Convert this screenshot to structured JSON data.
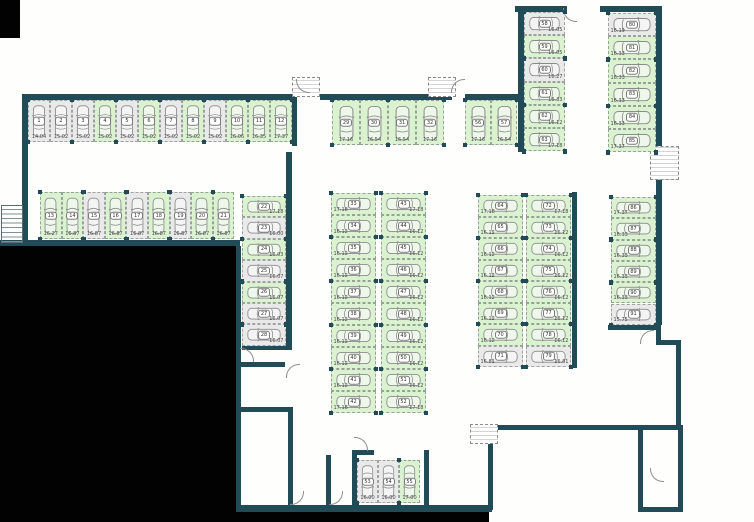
{
  "title": "underground parking garage floor plan",
  "colors": {
    "available_fill": "#daf2d0",
    "occupied_fill": "#e9e9e9",
    "wall": "#224b58",
    "background": "#ffffff",
    "outside_mask": "#000000",
    "dimension_text": "#4a4a4a"
  },
  "icons": {
    "car-icon": "top-view car outline drawn in each stall",
    "door-swing-icon": "quarter-circle arc",
    "vent-shaft-icon": "dashed hatched box",
    "stairs-icon": "striped rectangle",
    "column-pillar-icon": "small dark square"
  },
  "plan": {
    "groups": [
      {
        "id": "row-top-left",
        "x": 28,
        "y": 100,
        "sw": 22,
        "sh": 42,
        "dir": "up",
        "dim_side": "bottom",
        "stalls": [
          {
            "n": "1",
            "dim": "14.04",
            "free": false
          },
          {
            "n": "2",
            "dim": "15.02",
            "free": false
          },
          {
            "n": "3",
            "dim": "15.02",
            "free": false
          },
          {
            "n": "4",
            "dim": "15.02",
            "free": true
          },
          {
            "n": "5",
            "dim": "15.02",
            "free": false
          },
          {
            "n": "6",
            "dim": "15.02",
            "free": true
          },
          {
            "n": "7",
            "dim": "15.02",
            "free": false
          },
          {
            "n": "8",
            "dim": "15.02",
            "free": true
          },
          {
            "n": "9",
            "dim": "15.02",
            "free": false
          },
          {
            "n": "10",
            "dim": "16.06",
            "free": true
          },
          {
            "n": "11",
            "dim": "16.35",
            "free": true
          },
          {
            "n": "12",
            "dim": "17.37",
            "free": true
          }
        ]
      },
      {
        "id": "row-second-left",
        "x": 40,
        "y": 192,
        "sw": 21.6,
        "sh": 47,
        "dir": "up",
        "dim_side": "bottom",
        "stalls": [
          {
            "n": "13",
            "dim": "16.27",
            "free": true
          },
          {
            "n": "14",
            "dim": "16.87",
            "free": true
          },
          {
            "n": "15",
            "dim": "16.87",
            "free": false
          },
          {
            "n": "16",
            "dim": "16.87",
            "free": true
          },
          {
            "n": "17",
            "dim": "16.87",
            "free": false
          },
          {
            "n": "18",
            "dim": "16.87",
            "free": true
          },
          {
            "n": "19",
            "dim": "16.87",
            "free": false
          },
          {
            "n": "20",
            "dim": "16.87",
            "free": true
          },
          {
            "n": "21",
            "dim": "16.87",
            "free": true
          }
        ]
      },
      {
        "id": "col-left",
        "x": 242,
        "y": 196,
        "sw": 44,
        "sh": 21.4,
        "dir": "left",
        "dim_side": "right",
        "stalls": [
          {
            "n": "22",
            "dim": "17.18",
            "free": true
          },
          {
            "n": "23",
            "dim": "16.00",
            "free": false
          },
          {
            "n": "24",
            "dim": "16.03",
            "free": true
          },
          {
            "n": "25",
            "dim": "16.07",
            "free": false
          },
          {
            "n": "26",
            "dim": "16.07",
            "free": true
          },
          {
            "n": "27",
            "dim": "16.07",
            "free": false
          },
          {
            "n": "28",
            "dim": "16.07",
            "free": false
          }
        ]
      },
      {
        "id": "row-mid-top",
        "x": 332,
        "y": 100,
        "sw": 28,
        "sh": 45,
        "dir": "up",
        "dim_side": "bottom",
        "stalls": [
          {
            "n": "29",
            "dim": "17.16",
            "free": true
          },
          {
            "n": "30",
            "dim": "16.54",
            "free": true
          },
          {
            "n": "31",
            "dim": "16.54",
            "free": true
          },
          {
            "n": "32",
            "dim": "17.16",
            "free": true
          }
        ]
      },
      {
        "id": "block-mid-west",
        "x": 331,
        "y": 193,
        "sw": 45,
        "sh": 22,
        "dir": "right",
        "dim_side": "left",
        "stalls": [
          {
            "n": "33",
            "dim": "17.18",
            "free": true
          },
          {
            "n": "34",
            "dim": "16.12",
            "free": true
          },
          {
            "n": "35",
            "dim": "16.12",
            "free": true
          },
          {
            "n": "36",
            "dim": "16.12",
            "free": true
          },
          {
            "n": "37",
            "dim": "16.12",
            "free": true
          },
          {
            "n": "38",
            "dim": "16.12",
            "free": true
          },
          {
            "n": "39",
            "dim": "16.12",
            "free": true
          },
          {
            "n": "40",
            "dim": "16.12",
            "free": true
          },
          {
            "n": "41",
            "dim": "16.12",
            "free": true
          },
          {
            "n": "42",
            "dim": "17.18",
            "free": true
          }
        ]
      },
      {
        "id": "block-mid-east",
        "x": 381,
        "y": 193,
        "sw": 45,
        "sh": 22,
        "dir": "left",
        "dim_side": "right",
        "stalls": [
          {
            "n": "43",
            "dim": "17.18",
            "free": true
          },
          {
            "n": "44",
            "dim": "16.12",
            "free": true
          },
          {
            "n": "45",
            "dim": "16.12",
            "free": true
          },
          {
            "n": "46",
            "dim": "16.12",
            "free": true
          },
          {
            "n": "47",
            "dim": "16.12",
            "free": true
          },
          {
            "n": "48",
            "dim": "16.12",
            "free": true
          },
          {
            "n": "49",
            "dim": "16.12",
            "free": true
          },
          {
            "n": "50",
            "dim": "16.12",
            "free": true
          },
          {
            "n": "51",
            "dim": "16.12",
            "free": true
          },
          {
            "n": "52",
            "dim": "17.18",
            "free": true
          }
        ]
      },
      {
        "id": "room-bottom-center",
        "x": 357,
        "y": 460,
        "sw": 21,
        "sh": 43,
        "dir": "down",
        "dim_side": "bottom",
        "stalls": [
          {
            "n": "53",
            "dim": "16.00",
            "free": false
          },
          {
            "n": "54",
            "dim": "16.00",
            "free": false
          },
          {
            "n": "55",
            "dim": "17.00",
            "free": true
          }
        ]
      },
      {
        "id": "row-56-57",
        "x": 465,
        "y": 100,
        "sw": 26,
        "sh": 45,
        "dir": "up",
        "dim_side": "bottom",
        "stalls": [
          {
            "n": "56",
            "dim": "17.16",
            "free": true
          },
          {
            "n": "57",
            "dim": "16.54",
            "free": true
          }
        ]
      },
      {
        "id": "col-topright-west",
        "x": 524,
        "y": 12,
        "sw": 41,
        "sh": 23.2,
        "dir": "left",
        "dim_side": "right",
        "stalls": [
          {
            "n": "58",
            "dim": "16.05",
            "free": false
          },
          {
            "n": "59",
            "dim": "16.05",
            "free": true
          },
          {
            "n": "60",
            "dim": "16.27",
            "free": false
          },
          {
            "n": "61",
            "dim": "16.33",
            "free": true
          },
          {
            "n": "62",
            "dim": "16.12",
            "free": true
          },
          {
            "n": "63",
            "dim": "17.18",
            "free": true
          }
        ]
      },
      {
        "id": "col-topright-east",
        "x": 608,
        "y": 13,
        "sw": 48,
        "sh": 23.2,
        "dir": "right",
        "dim_side": "left",
        "stalls": [
          {
            "n": "80",
            "dim": "16.19",
            "free": false
          },
          {
            "n": "81",
            "dim": "16.33",
            "free": true
          },
          {
            "n": "82",
            "dim": "16.33",
            "free": true
          },
          {
            "n": "83",
            "dim": "16.33",
            "free": true
          },
          {
            "n": "84",
            "dim": "16.33",
            "free": true
          },
          {
            "n": "85",
            "dim": "17.37",
            "free": true
          }
        ]
      },
      {
        "id": "block-right-west",
        "x": 478,
        "y": 195,
        "sw": 45,
        "sh": 21.5,
        "dir": "right",
        "dim_side": "left",
        "stalls": [
          {
            "n": "64",
            "dim": "17.18",
            "free": true
          },
          {
            "n": "65",
            "dim": "16.12",
            "free": true
          },
          {
            "n": "66",
            "dim": "16.12",
            "free": true
          },
          {
            "n": "67",
            "dim": "16.12",
            "free": true
          },
          {
            "n": "68",
            "dim": "16.12",
            "free": true
          },
          {
            "n": "69",
            "dim": "16.12",
            "free": true
          },
          {
            "n": "70",
            "dim": "16.12",
            "free": true
          },
          {
            "n": "71",
            "dim": "16.81",
            "free": false
          }
        ]
      },
      {
        "id": "block-right-east",
        "x": 526,
        "y": 195,
        "sw": 45,
        "sh": 21.5,
        "dir": "left",
        "dim_side": "right",
        "stalls": [
          {
            "n": "72",
            "dim": "17.18",
            "free": true
          },
          {
            "n": "73",
            "dim": "16.12",
            "free": true
          },
          {
            "n": "74",
            "dim": "16.12",
            "free": true
          },
          {
            "n": "75",
            "dim": "16.12",
            "free": true
          },
          {
            "n": "76",
            "dim": "16.12",
            "free": true
          },
          {
            "n": "77",
            "dim": "16.12",
            "free": true
          },
          {
            "n": "78",
            "dim": "16.12",
            "free": true
          },
          {
            "n": "79",
            "dim": "16.81",
            "free": false
          }
        ]
      },
      {
        "id": "col-far-right",
        "x": 611,
        "y": 197,
        "sw": 45,
        "sh": 21.3,
        "dir": "right",
        "dim_side": "left",
        "stalls": [
          {
            "n": "86",
            "dim": "17.37",
            "free": true
          },
          {
            "n": "87",
            "dim": "16.33",
            "free": true
          },
          {
            "n": "88",
            "dim": "16.33",
            "free": true
          },
          {
            "n": "89",
            "dim": "16.33",
            "free": true
          },
          {
            "n": "90",
            "dim": "16.33",
            "free": true
          },
          {
            "n": "91",
            "dim": "15.75",
            "free": false
          }
        ]
      }
    ]
  }
}
